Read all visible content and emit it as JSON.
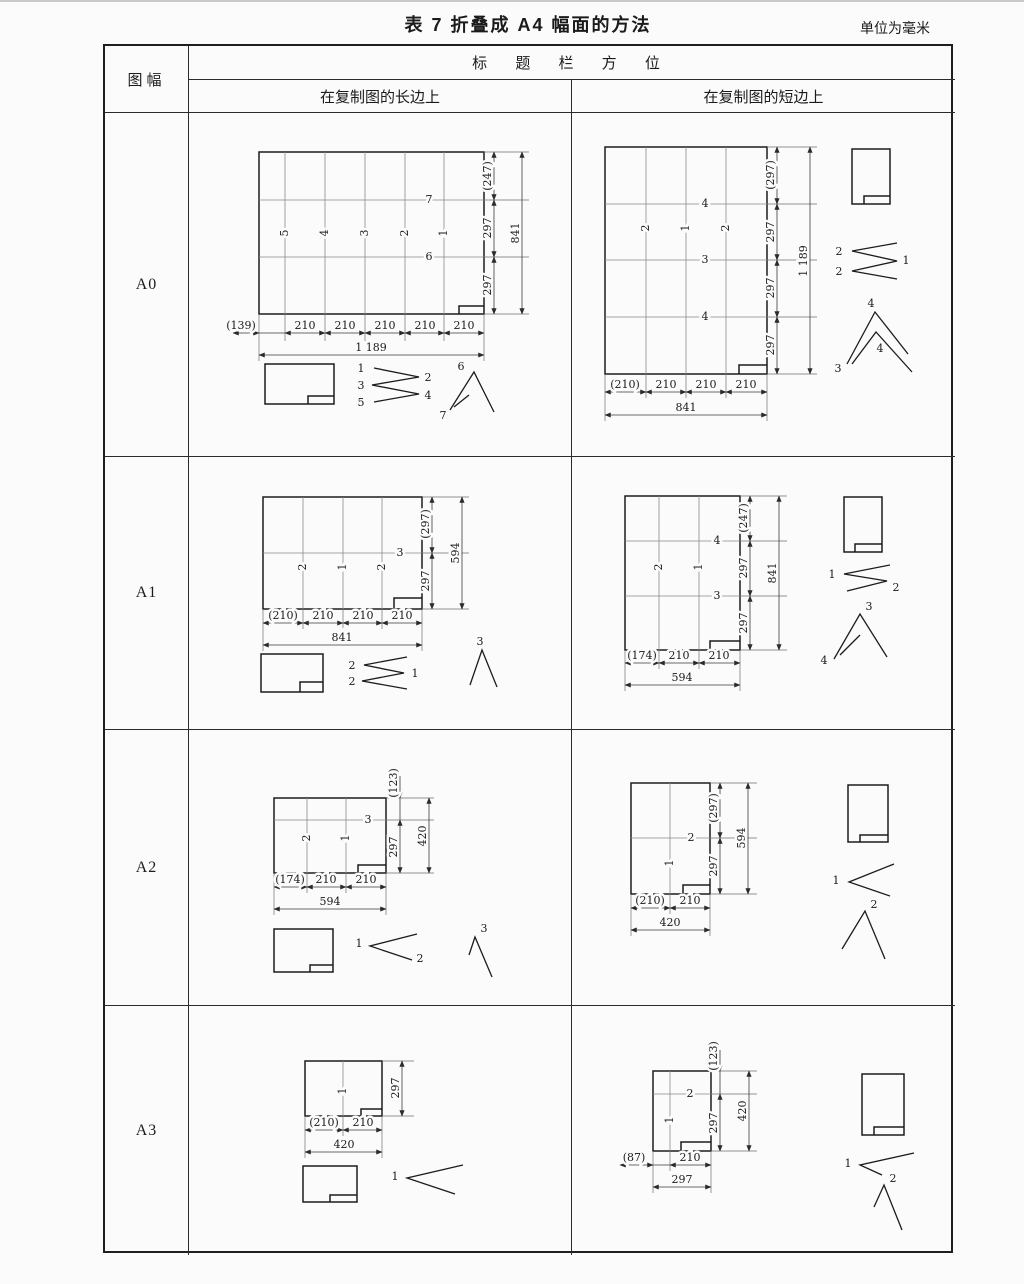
{
  "caption": "表 7  折叠成 A4 幅面的方法",
  "units": "单位为毫米",
  "header": {
    "figure_col": "图幅",
    "title": "标 题 栏 方 位",
    "long_edge": "在复制图的长边上",
    "short_edge": "在复制图的短边上"
  },
  "rows": [
    {
      "size": "A0",
      "long": {
        "v_folds": [
          "5",
          "4",
          "3",
          "2",
          "1"
        ],
        "h_folds": [
          "7",
          "6"
        ],
        "right_dims": [
          "(247)",
          "297",
          "297"
        ],
        "right_total": "841",
        "bottom_dims": [
          "(139)",
          "210",
          "210",
          "210",
          "210",
          "210"
        ],
        "bottom_total": "1 189",
        "zigzag_left": [
          "1",
          "3",
          "5"
        ],
        "zigzag_right": [
          "2",
          "4"
        ],
        "chevron": [
          "6",
          "7"
        ]
      },
      "short": {
        "v_folds": [
          "2",
          "1",
          "2"
        ],
        "h_folds": [
          "4",
          "3",
          "4"
        ],
        "right_dims": [
          "(297)",
          "297",
          "297",
          "297"
        ],
        "right_total": "1 189",
        "bottom_dims": [
          "(210)",
          "210",
          "210",
          "210"
        ],
        "bottom_total": "841",
        "zigzag_left": [
          "2",
          "2"
        ],
        "zigzag_right": [
          "1"
        ],
        "chevron": [
          "4",
          "4",
          "3"
        ]
      }
    },
    {
      "size": "A1",
      "long": {
        "v_folds": [
          "2",
          "1",
          "2"
        ],
        "h_folds": [
          "3"
        ],
        "right_dims": [
          "(297)",
          "297"
        ],
        "right_total": "594",
        "bottom_dims": [
          "(210)",
          "210",
          "210",
          "210"
        ],
        "bottom_total": "841",
        "zigzag_left": [
          "2",
          "2"
        ],
        "zigzag_right": [
          "1"
        ],
        "chevron": [
          "3"
        ]
      },
      "short": {
        "v_folds": [
          "2",
          "1"
        ],
        "h_folds": [
          "4",
          "3"
        ],
        "right_dims": [
          "(247)",
          "297",
          "297"
        ],
        "right_total": "841",
        "bottom_dims": [
          "(174)",
          "210",
          "210"
        ],
        "bottom_total": "594",
        "zigzag_left": [
          "1"
        ],
        "zigzag_right": [
          "2"
        ],
        "chevron": [
          "3",
          "4"
        ]
      }
    },
    {
      "size": "A2",
      "long": {
        "v_folds": [
          "2",
          "1"
        ],
        "h_folds": [
          "3"
        ],
        "right_dims": [
          "(123)",
          "297"
        ],
        "right_total": "420",
        "bottom_dims": [
          "(174)",
          "210",
          "210"
        ],
        "bottom_total": "594",
        "zigzag_left": [
          "1"
        ],
        "zigzag_right": [
          "2"
        ],
        "chevron": [
          "3"
        ]
      },
      "short": {
        "v_folds": [
          "1"
        ],
        "h_folds": [
          "2"
        ],
        "right_dims": [
          "(297)",
          "297"
        ],
        "right_total": "594",
        "bottom_dims": [
          "(210)",
          "210"
        ],
        "bottom_total": "420",
        "zigzag_left": [
          "1"
        ],
        "zigzag_right": [],
        "chevron": [
          "2"
        ]
      }
    },
    {
      "size": "A3",
      "long": {
        "v_folds": [
          "1"
        ],
        "h_folds": [],
        "right_dims": [
          "297"
        ],
        "right_total": "",
        "bottom_dims": [
          "(210)",
          "210"
        ],
        "bottom_total": "420",
        "zigzag_left": [
          "1"
        ],
        "zigzag_right": [],
        "chevron": []
      },
      "short": {
        "v_folds": [
          "1"
        ],
        "h_folds": [
          "2"
        ],
        "right_dims": [
          "(123)",
          "297"
        ],
        "right_total": "420",
        "bottom_dims": [
          "(87)",
          "210"
        ],
        "bottom_total": "297",
        "zigzag_left": [
          "1"
        ],
        "zigzag_right": [],
        "chevron": [
          "2"
        ]
      }
    }
  ]
}
